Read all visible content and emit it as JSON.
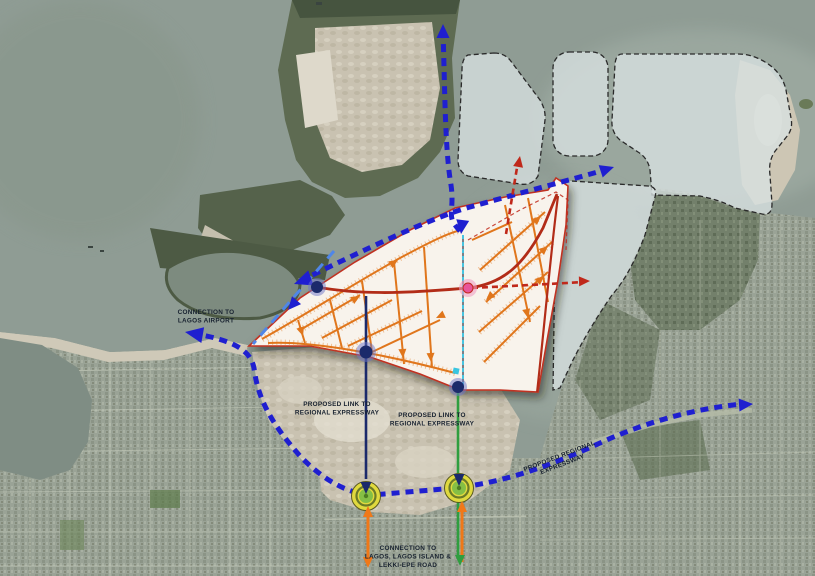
{
  "map": {
    "title": "Masterplan aerial overlay map",
    "labels": {
      "connection_airport": {
        "line1": "CONNECTION TO",
        "line2": "LAGOS AIRPORT"
      },
      "link_left": {
        "line1": "PROPOSED LINK TO",
        "line2": "REGIONAL EXPRESSWAY"
      },
      "link_right": {
        "line1": "PROPOSED LINK TO",
        "line2": "REGIONAL EXPRESSWAY"
      },
      "regional_expressway": {
        "line1": "PROPOSED REGIONAL",
        "line2": "EXPRESSWAY"
      },
      "connection_lagos": {
        "line1": "CONNECTION TO",
        "line2": "LAGOS, LAGOS ISLAND &",
        "line3": "LEKKI-EPE ROAD"
      }
    },
    "colors": {
      "water": "#8f9c94",
      "route_primary": "#1f1fd0",
      "route_secondary": "#4f86e8",
      "route_red": "#c0281a",
      "plan_fill": "#f8f3ec",
      "plan_street": "#e0761c",
      "plan_spine": "#b22c18",
      "connector_navy": "#1b2a6b",
      "connector_green": "#2f9e3f",
      "connector_orange": "#f07818",
      "roundabout_yellow": "#e0d93e",
      "roundabout_green": "#85bf45",
      "parcel_fill": "#d9e1e1",
      "sand": "#c9c2b1",
      "vegetation": "#55624b",
      "urban": "#9aa396"
    }
  }
}
